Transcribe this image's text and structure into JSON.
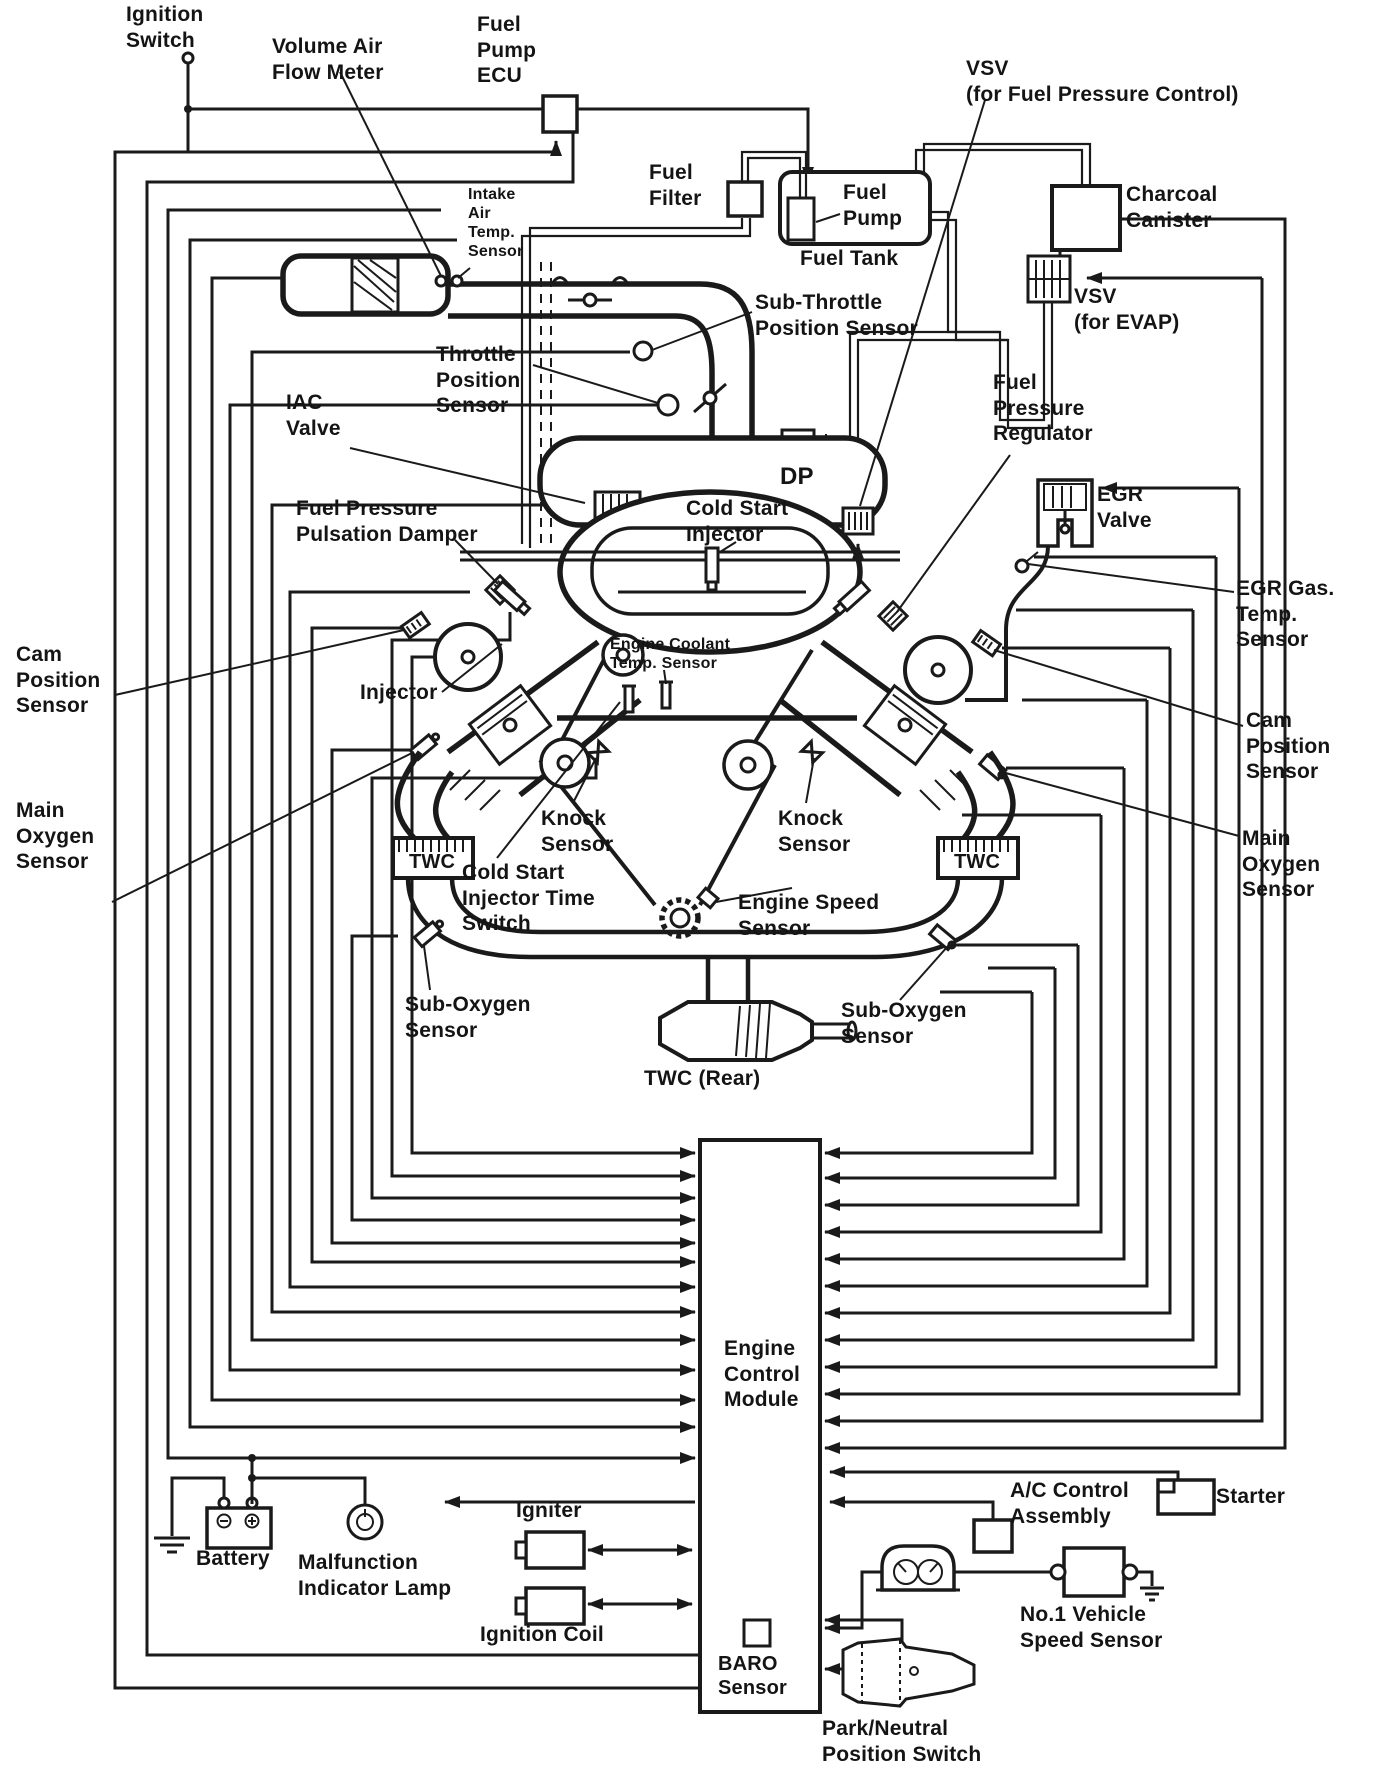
{
  "colors": {
    "ink": "#1a1a1a",
    "paper": "#ffffff"
  },
  "labels": {
    "ignition_switch": "Ignition\nSwitch",
    "volume_air_flow_meter": "Volume Air\nFlow Meter",
    "fuel_pump_ecu": "Fuel\nPump\nECU",
    "intake_air_temp_sensor": "Intake\nAir\nTemp.\nSensor",
    "fuel_filter": "Fuel\nFilter",
    "fuel_pump": "Fuel\nPump",
    "fuel_tank": "Fuel Tank",
    "vsv_fuel_pressure_control": "VSV\n(for Fuel Pressure Control)",
    "charcoal_canister": "Charcoal\nCanister",
    "vsv_evap": "VSV\n(for EVAP)",
    "sub_throttle_position_sensor": "Sub-Throttle\nPosition Sensor",
    "throttle_position_sensor": "Throttle\nPosition\nSensor",
    "iac_valve": "IAC\nValve",
    "fuel_pressure_regulator": "Fuel\nPressure\nRegulator",
    "dp": "DP",
    "cold_start_injector": "Cold Start\nInjector",
    "egr_valve": "EGR\nValve",
    "egr_gas_temp_sensor": "EGR Gas.\nTemp.\nSensor",
    "fuel_pressure_pulsation_damper": "Fuel Pressure\nPulsation Damper",
    "cam_position_sensor_left": "Cam\nPosition\nSensor",
    "cam_position_sensor_right": "Cam\nPosition\nSensor",
    "engine_coolant_temp_sensor": "Engine Coolant\nTemp. Sensor",
    "injector": "Injector",
    "main_oxygen_sensor_left": "Main\nOxygen\nSensor",
    "main_oxygen_sensor_right": "Main\nOxygen\nSensor",
    "knock_sensor_left": "Knock\nSensor",
    "knock_sensor_right": "Knock\nSensor",
    "twc_left": "TWC",
    "twc_right": "TWC",
    "cold_start_injector_time_switch": "Cold Start\nInjector Time\nSwitch",
    "engine_speed_sensor": "Engine Speed\nSensor",
    "sub_oxygen_sensor_left": "Sub-Oxygen\nSensor",
    "sub_oxygen_sensor_right": "Sub-Oxygen\nSensor",
    "twc_rear": "TWC (Rear)",
    "engine_control_module": "Engine\nControl\nModule",
    "battery": "Battery",
    "malfunction_indicator_lamp": "Malfunction\nIndicator Lamp",
    "igniter": "Igniter",
    "ignition_coil": "Ignition Coil",
    "baro_sensor": "BARO\nSensor",
    "park_neutral_position_switch": "Park/Neutral\nPosition Switch",
    "ac_control_assembly": "A/C Control\nAssembly",
    "starter": "Starter",
    "no1_vehicle_speed_sensor": "No.1 Vehicle\nSpeed Sensor"
  }
}
